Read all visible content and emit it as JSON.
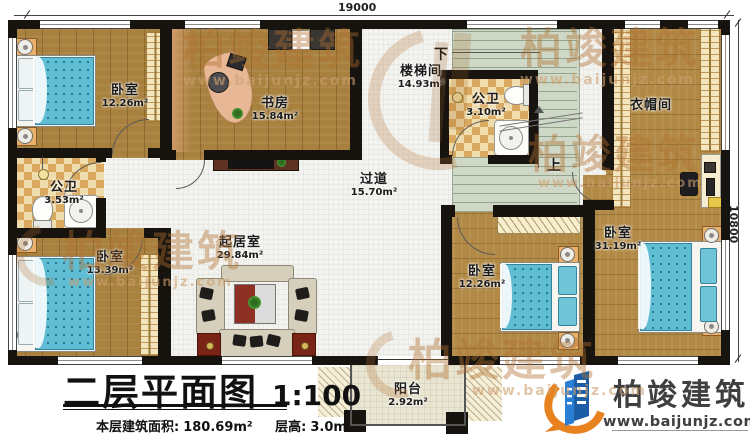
{
  "dimensions": {
    "top": "19000",
    "right": "10800"
  },
  "rooms": [
    {
      "id": "bedroom-tl",
      "name": "卧室",
      "area": "12.26m²"
    },
    {
      "id": "study",
      "name": "书房",
      "area": "15.84m²"
    },
    {
      "id": "bath-left",
      "name": "公卫",
      "area": "3.53m²"
    },
    {
      "id": "bedroom-bl",
      "name": "卧室",
      "area": "13.39m²"
    },
    {
      "id": "living",
      "name": "起居室",
      "area": "29.84m²"
    },
    {
      "id": "corridor",
      "name": "过道",
      "area": "15.70m²"
    },
    {
      "id": "stairwell",
      "name": "楼梯间",
      "area": "14.93m²"
    },
    {
      "id": "bath-stair",
      "name": "公卫",
      "area": "3.10m²"
    },
    {
      "id": "cloakroom",
      "name": "衣帽间",
      "area": ""
    },
    {
      "id": "bedroom-br",
      "name": "卧室",
      "area": "12.26m²"
    },
    {
      "id": "bedroom-master",
      "name": "卧室",
      "area": "31.19m²"
    },
    {
      "id": "balcony",
      "name": "阳台",
      "area": "2.92m²"
    }
  ],
  "stairs": {
    "down": "下",
    "up": "上"
  },
  "title": {
    "main": "二层平面图",
    "scale": "1:100",
    "area_label": "本层建筑面积:",
    "area_value": "180.69m²",
    "height_label": "层高:",
    "height_value": "3.0m"
  },
  "brand": {
    "name": "柏竣建筑",
    "url": "www.baijunjz.com"
  },
  "watermark": {
    "text": "柏竣建筑",
    "url": "www.baijunjz.com"
  },
  "colors": {
    "wall": "#17130f",
    "wood": "#a8813f",
    "bed": "#5fbdd4",
    "stairs": "#cfd8c6",
    "brand_blue": "#1b5ea6",
    "brand_orange": "#e8821e"
  }
}
